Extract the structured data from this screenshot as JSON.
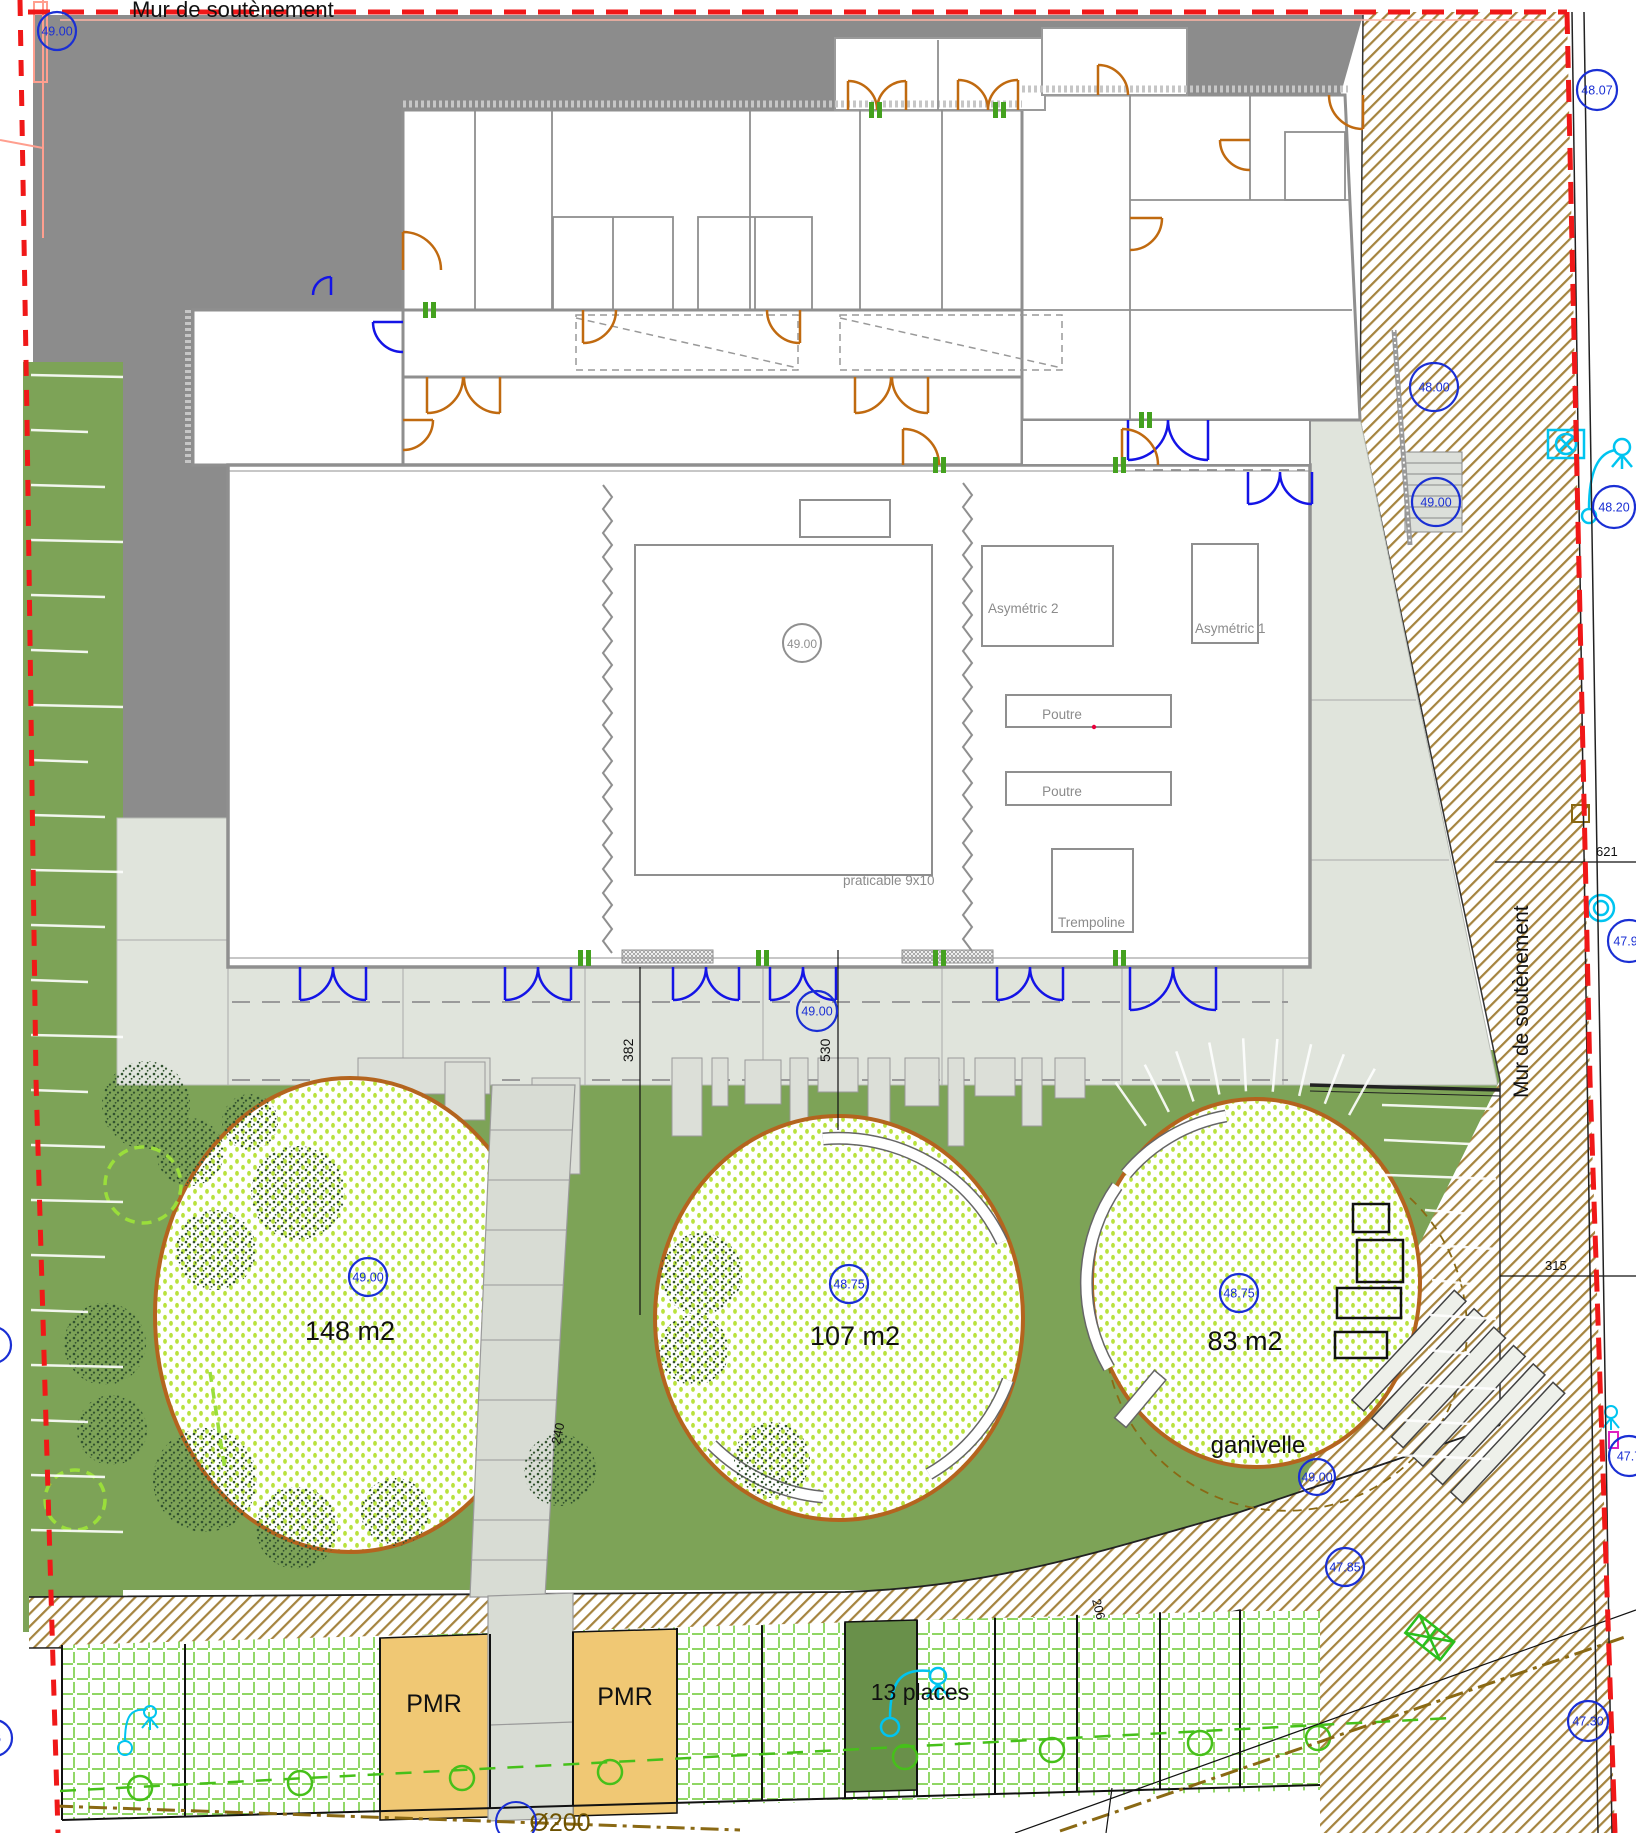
{
  "plan": {
    "top_title": "Mur de soutènement",
    "right_wall_label": "Mur de soutènement",
    "gym": {
      "asymetric_2": "Asymétric 2",
      "asymetric_1": "Asymétric 1",
      "poutre_1": "Poutre",
      "poutre_2": "Poutre",
      "trampoline": "Trempoline",
      "mat": "praticable 9x10",
      "mat_level": "49.00"
    },
    "play_areas": {
      "area_1": "148 m2",
      "area_2": "107 m2",
      "area_3": "83 m2",
      "fence": "ganivelle"
    },
    "parking": {
      "pmr_1": "PMR",
      "pmr_2": "PMR",
      "places": "13 places",
      "pipe": "Ø200"
    },
    "dimensions": {
      "d382": "382",
      "d530": "530",
      "d240": "240",
      "d621": "621",
      "d315": "315",
      "d206": "206"
    },
    "levels": [
      {
        "value": "49.00"
      },
      {
        "value": "48.07"
      },
      {
        "value": "48.00"
      },
      {
        "value": "49.00"
      },
      {
        "value": "48.20"
      },
      {
        "value": "47.95"
      },
      {
        "value": "49.00"
      },
      {
        "value": "49.00"
      },
      {
        "value": "48.75"
      },
      {
        "value": "48.75"
      },
      {
        "value": "49.00"
      },
      {
        "value": "47.85"
      },
      {
        "value": "47.30"
      },
      {
        "value": "47.7"
      },
      {
        "value": "1"
      },
      {
        "value": "06"
      }
    ],
    "colors": {
      "boundary_red": "#f01818",
      "lawn_green": "#7da357",
      "sand_border": "#b4641e",
      "pmr_orange": "#f0c874",
      "door_blue": "#1414e6",
      "door_orange": "#c06a10",
      "utility_cyan": "#00c4f0",
      "hatch_brown": "#a5843f",
      "elevation_blue": "#1a2fd4",
      "paver_green": "#7fd14e"
    }
  }
}
